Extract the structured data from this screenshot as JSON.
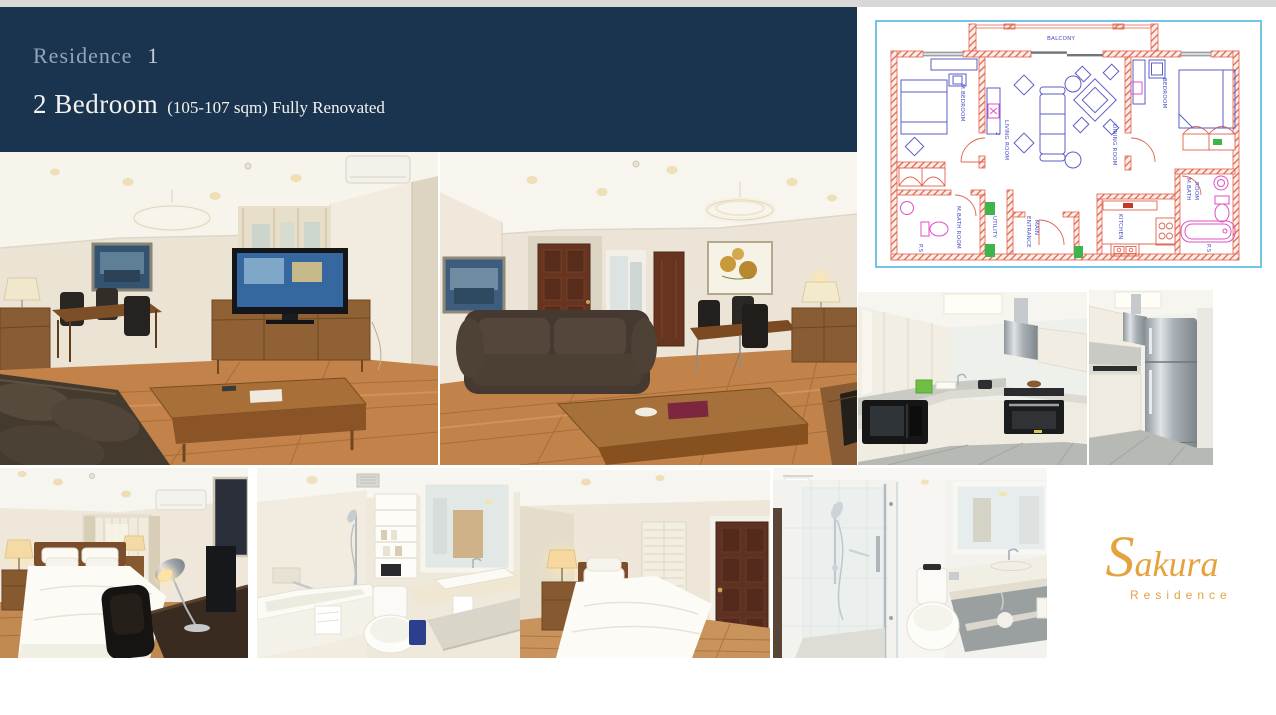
{
  "slide": {
    "background_color": "#ffffff",
    "top_strip_color": "#d8d8d8"
  },
  "header": {
    "background_color": "#1a3450",
    "residence_label": "Residence",
    "residence_number": "1",
    "unit_type": "2 Bedroom",
    "unit_details": "(105-107 sqm) Fully Renovated"
  },
  "floorplan": {
    "border_color": "#73c4e5",
    "wall_color": "#e0634e",
    "furniture_color": "#5b5ec6",
    "fixture_color": "#e14fc3",
    "marker_green": "#3db54a",
    "label_color": "#4a4ecb",
    "labels": {
      "balcony": "BALCONY",
      "master_bedroom": "M.BEDROOM",
      "living_room": "LIVING ROOM",
      "living_room_number": "2",
      "dining_room": "DINING ROOM",
      "bedroom": "BEDROOM",
      "master_bath_left": "M.BATH ROOM",
      "master_bath_right_1": "M.BATH",
      "master_bath_right_2": "ROOM",
      "utility": "UTILITY",
      "main_entrance_1": "ENTRANCE",
      "main_entrance_2": "MAIN",
      "kitchen": "KITCHEN",
      "ps_left": "P.S",
      "ps_right": "P.S"
    }
  },
  "gallery": {
    "photos": [
      {
        "id": "living-room-1"
      },
      {
        "id": "living-room-2"
      },
      {
        "id": "kitchen-1"
      },
      {
        "id": "kitchen-2"
      },
      {
        "id": "bedroom-1"
      },
      {
        "id": "bathroom-1"
      },
      {
        "id": "bedroom-2"
      },
      {
        "id": "bathroom-2"
      }
    ]
  },
  "logo": {
    "brand": "Sakura",
    "subtitle": "Residence",
    "color": "#e5a33f"
  }
}
